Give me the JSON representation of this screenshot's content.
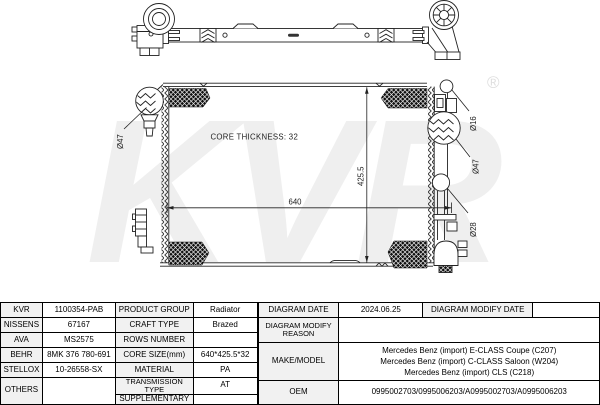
{
  "colors": {
    "line": "#222222",
    "hatch_fill": "#101010",
    "watermark": "#ededed",
    "header_bg": "#f1f1f1",
    "border": "#000000"
  },
  "watermark": {
    "text": "KVR",
    "reg": "®"
  },
  "drawing": {
    "core_thickness": "CORE THICKNESS: 32",
    "dim_width": "640",
    "dim_height": "425.5",
    "port_left": "Ø47",
    "port_right_top": "Ø16",
    "port_right_mid": "Ø47",
    "port_right_bottom": "Ø28"
  },
  "table": {
    "brands": [
      {
        "name": "KVR",
        "code": "1100354-PAB"
      },
      {
        "name": "NISSENS",
        "code": "67167"
      },
      {
        "name": "AVA",
        "code": "MS2575"
      },
      {
        "name": "BEHR",
        "code": "8MK 376 780-691"
      },
      {
        "name": "STELLOX",
        "code": "10-26558-SX"
      },
      {
        "name": "OTHERS",
        "code": ""
      }
    ],
    "props": [
      {
        "label": "PRODUCT GROUP",
        "value": "Radiator"
      },
      {
        "label": "CRAFT TYPE",
        "value": "Brazed"
      },
      {
        "label": "ROWS NUMBER",
        "value": ""
      },
      {
        "label": "CORE SIZE(mm)",
        "value": "640*425.5*32"
      },
      {
        "label": "MATERIAL",
        "value": "PA"
      },
      {
        "label": "TRANSMISSION TYPE",
        "value": "AT"
      },
      {
        "label": "SUPPLEMENTARY",
        "value": ""
      }
    ],
    "diagram_date_label": "DIAGRAM DATE",
    "diagram_date": "2024.06.25",
    "modify_date_label": "DIAGRAM MODIFY DATE",
    "modify_date": "",
    "modify_reason_label": "DIAGRAM MODIFY REASON",
    "modify_reason": "",
    "make_model_label": "MAKE/MODEL",
    "make_model": [
      "Mercedes Benz (import) E-CLASS Coupe (C207)",
      "Mercedes Benz (import) C-CLASS Saloon (W204)",
      "Mercedes Benz (import) CLS (C218)"
    ],
    "oem_label": "OEM",
    "oem": "0995002703/0995006203/A0995002703/A0995006203"
  }
}
